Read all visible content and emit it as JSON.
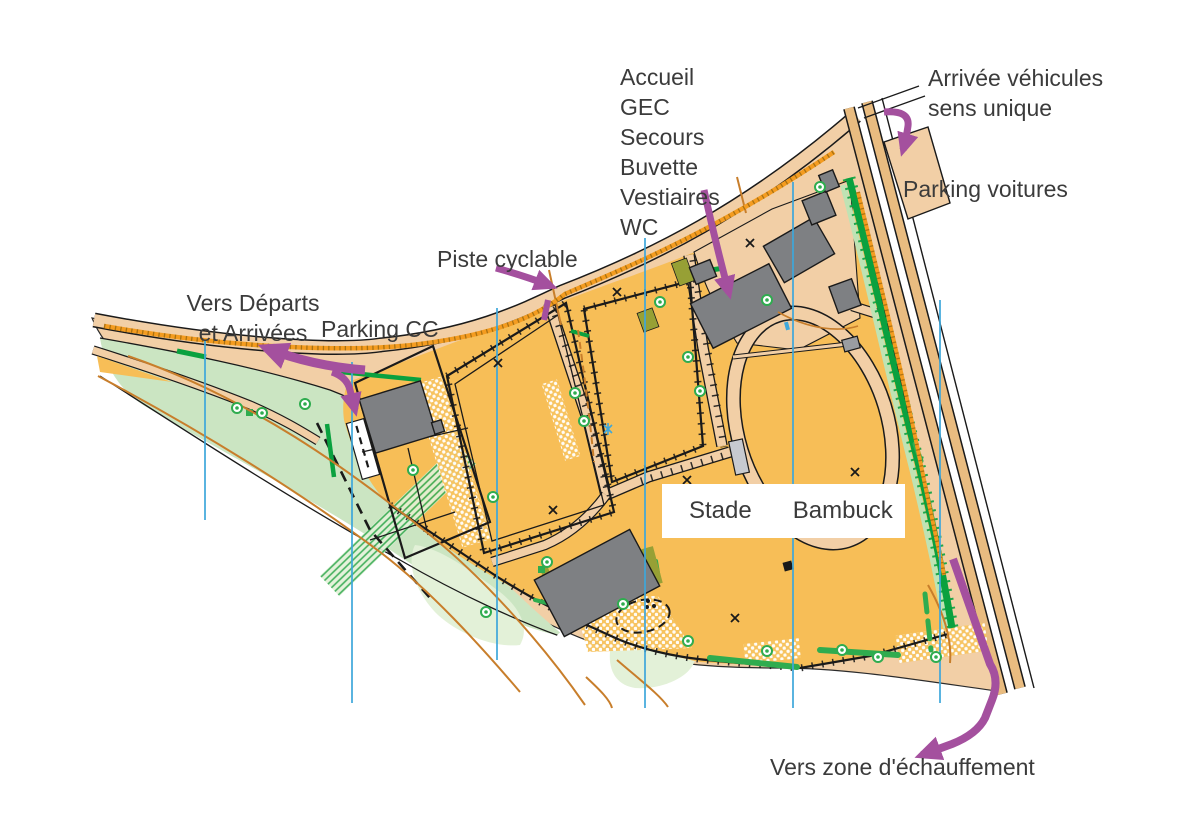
{
  "labels": {
    "services": {
      "lines": [
        "Accueil",
        "GEC",
        "Secours",
        "Buvette",
        "Vestiaires",
        "WC"
      ]
    },
    "vehicle_arrival": {
      "lines": [
        "Arrivée véhicules",
        "sens unique"
      ]
    },
    "parking_cars": "Parking voitures",
    "bike_path": "Piste cyclable",
    "to_start_finish": {
      "lines": [
        "Vers Départs",
        "et Arrivées"
      ]
    },
    "parking_cc": "Parking CC",
    "stadium": {
      "word1": "Stade",
      "word2": "Bambuck"
    },
    "warmup": "Vers zone d'échauffement"
  },
  "palette": {
    "open_land_orange": "#F7BE57",
    "paved_tan": "#F2CFA6",
    "road_tan": "#E9BC80",
    "grass_green": "#CBE5C2",
    "pale_green": "#E3F1D8",
    "hedge_dark_green": "#0AA13F",
    "bush_strip_green": "#2FAC4F",
    "olive_flowerbed": "#97A035",
    "building_gray": "#7E8083",
    "canopy_light_gray": "#C7CAD0",
    "north_line_blue": "#3EA7DB",
    "contour_orange": "#C87E2B",
    "annotation_purple": "#A4509E",
    "label_text": "#3B3B3B"
  },
  "map_features": [
    "athletics-track-oval",
    "fenced-sports-fields",
    "gray-buildings",
    "car-parking-area",
    "cc-parking-area",
    "cycle-path",
    "hedgerows",
    "grass-wedge",
    "magnetic-north-lines",
    "contour-lines",
    "purple-route-arrows",
    "garden-area",
    "sandy-ground-patches"
  ]
}
